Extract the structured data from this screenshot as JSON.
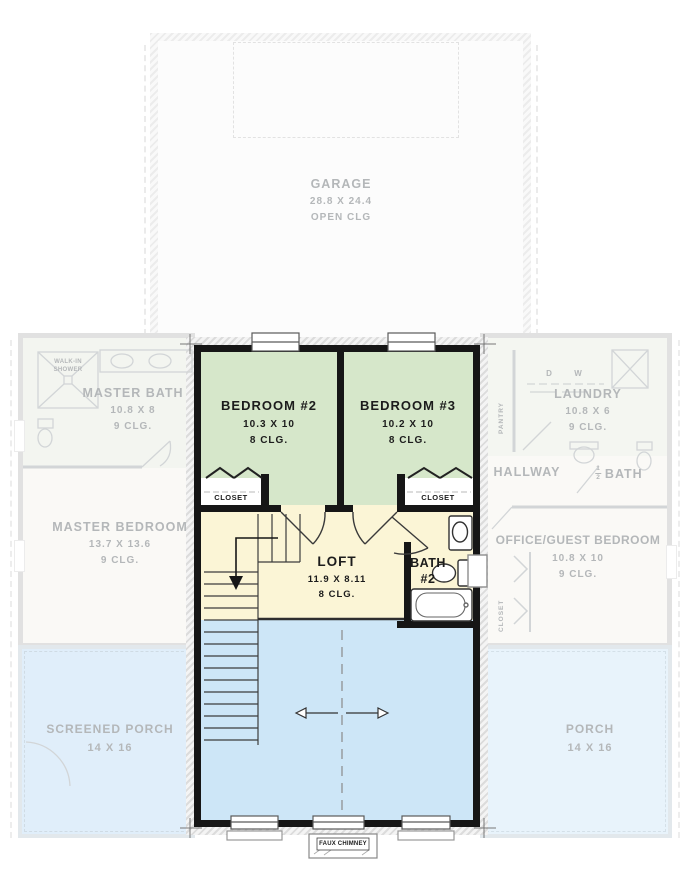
{
  "rooms": {
    "garage": {
      "name": "GARAGE",
      "dims": "28.8 X 24.4",
      "ceiling": "OPEN CLG"
    },
    "bedroom2": {
      "name": "BEDROOM #2",
      "dims": "10.3 X 10",
      "ceiling": "8 CLG."
    },
    "bedroom3": {
      "name": "BEDROOM #3",
      "dims": "10.2 X 10",
      "ceiling": "8 CLG."
    },
    "loft": {
      "name": "LOFT",
      "dims": "11.9 X 8.11",
      "ceiling": "8 CLG."
    },
    "bath2": {
      "line1": "BATH",
      "line2": "#2"
    },
    "closet_bedroom2": {
      "name": "CLOSET"
    },
    "closet_bedroom3": {
      "name": "CLOSET"
    },
    "master_bath": {
      "name": "MASTER BATH",
      "dims": "10.8 X 8",
      "ceiling": "9 CLG."
    },
    "walk_in_shower": {
      "line1": "WALK-IN",
      "line2": "SHOWER"
    },
    "master_bedroom": {
      "name": "MASTER BEDROOM",
      "dims": "13.7 X 13.6",
      "ceiling": "9 CLG."
    },
    "laundry": {
      "name": "LAUNDRY",
      "dims": "10.8 X 6",
      "ceiling": "9 CLG."
    },
    "pantry": {
      "name": "PANTRY"
    },
    "hallway": {
      "name": "HALLWAY"
    },
    "half_bath": {
      "numerator": "1",
      "denominator": "2",
      "name": "BATH"
    },
    "office_guest": {
      "name": "OFFICE/GUEST BEDROOM",
      "dims": "10.8 X 10",
      "ceiling": "9 CLG."
    },
    "office_closet": {
      "name": "CLOSET"
    },
    "screened_porch": {
      "name": "SCREENED PORCH",
      "dims": "14 X 16"
    },
    "porch": {
      "name": "PORCH",
      "dims": "14 X 16"
    }
  },
  "annotations": {
    "faux_chimney": "FAUX CHIMNEY",
    "dryer": "D",
    "washer": "W"
  },
  "colors": {
    "bedroom_green": "#d6e7ca",
    "loft_yellow": "#fbf5d6",
    "open_below_blue": "#cde6f7",
    "screened_porch_blue": "#e0eefa",
    "porch_blue": "#e8f3fb",
    "wall_black": "#161616",
    "faded_gray": "#b4b7b9"
  }
}
